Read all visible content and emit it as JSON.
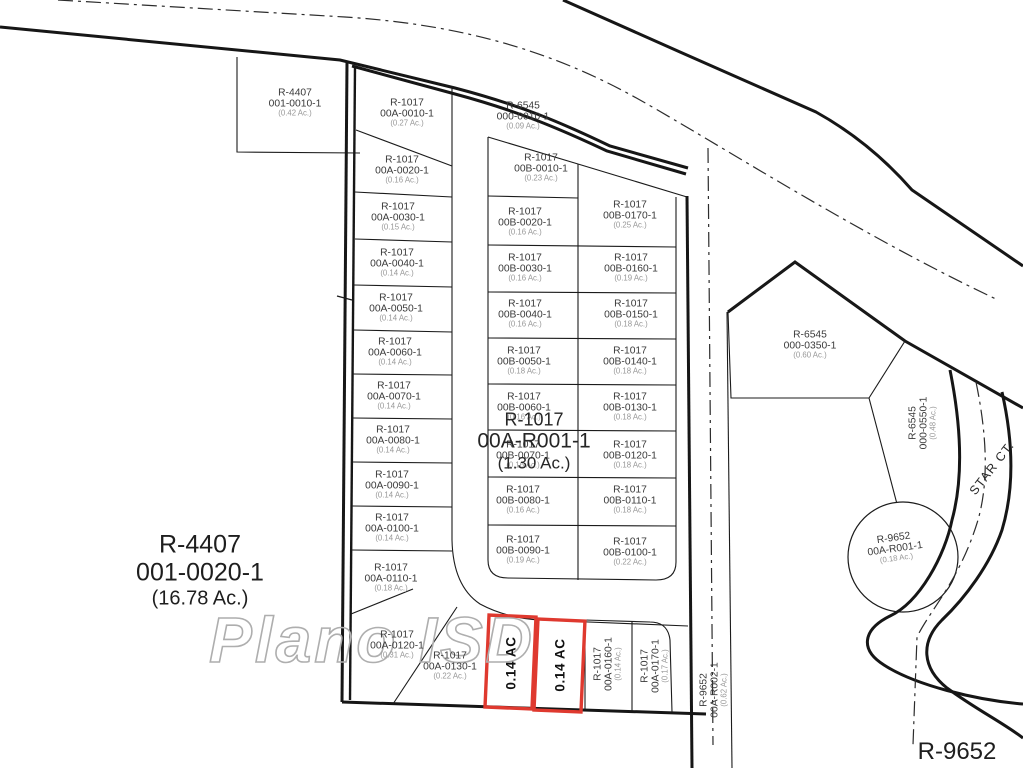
{
  "map": {
    "type": "parcel-plat-map",
    "watermark": {
      "text": "Plano ISD"
    },
    "highlight_color": "#df392f",
    "line_color": "#1b1b1b",
    "highlighted_lots": [
      {
        "label": "0.14 AC"
      },
      {
        "label": "0.14 AC"
      }
    ]
  },
  "labels": [
    {
      "name": "parcel-label-001-0010-1",
      "cls": "sm",
      "x": 295,
      "y": 103,
      "rot": 0,
      "lines": [
        "R-4407",
        "001-0010-1",
        "(0.42 Ac.)"
      ]
    },
    {
      "name": "parcel-label-000-0010-1",
      "cls": "sm",
      "x": 523,
      "y": 116,
      "rot": 0,
      "lines": [
        "R-6545",
        "000-0010-1",
        "(0.09 Ac.)"
      ]
    },
    {
      "name": "parcel-label-00A-0010-1",
      "cls": "sm",
      "x": 407,
      "y": 113,
      "rot": 0,
      "lines": [
        "R-1017",
        "00A-0010-1",
        "(0.27 Ac.)"
      ]
    },
    {
      "name": "parcel-label-00A-0020-1",
      "cls": "sm",
      "x": 402,
      "y": 170,
      "rot": 0,
      "lines": [
        "R-1017",
        "00A-0020-1",
        "(0.16 Ac.)"
      ]
    },
    {
      "name": "parcel-label-00A-0030-1",
      "cls": "sm",
      "x": 398,
      "y": 217,
      "rot": 0,
      "lines": [
        "R-1017",
        "00A-0030-1",
        "(0.15 Ac.)"
      ]
    },
    {
      "name": "parcel-label-00A-0040-1",
      "cls": "sm",
      "x": 397,
      "y": 263,
      "rot": 0,
      "lines": [
        "R-1017",
        "00A-0040-1",
        "(0.14 Ac.)"
      ]
    },
    {
      "name": "parcel-label-00A-0050-1",
      "cls": "sm",
      "x": 396,
      "y": 308,
      "rot": 0,
      "lines": [
        "R-1017",
        "00A-0050-1",
        "(0.14 Ac.)"
      ]
    },
    {
      "name": "parcel-label-00A-0060-1",
      "cls": "sm",
      "x": 395,
      "y": 352,
      "rot": 0,
      "lines": [
        "R-1017",
        "00A-0060-1",
        "(0.14 Ac.)"
      ]
    },
    {
      "name": "parcel-label-00A-0070-1",
      "cls": "sm",
      "x": 394,
      "y": 396,
      "rot": 0,
      "lines": [
        "R-1017",
        "00A-0070-1",
        "(0.14 Ac.)"
      ]
    },
    {
      "name": "parcel-label-00A-0080-1",
      "cls": "sm",
      "x": 393,
      "y": 440,
      "rot": 0,
      "lines": [
        "R-1017",
        "00A-0080-1",
        "(0.14 Ac.)"
      ]
    },
    {
      "name": "parcel-label-00A-0090-1",
      "cls": "sm",
      "x": 392,
      "y": 485,
      "rot": 0,
      "lines": [
        "R-1017",
        "00A-0090-1",
        "(0.14 Ac.)"
      ]
    },
    {
      "name": "parcel-label-00A-0100-1",
      "cls": "sm",
      "x": 392,
      "y": 528,
      "rot": 0,
      "lines": [
        "R-1017",
        "00A-0100-1",
        "(0.14 Ac.)"
      ]
    },
    {
      "name": "parcel-label-00A-0110-1",
      "cls": "sm",
      "x": 391,
      "y": 578,
      "rot": 0,
      "lines": [
        "R-1017",
        "00A-0110-1",
        "(0.18 Ac.)"
      ]
    },
    {
      "name": "parcel-label-00A-0120-1",
      "cls": "sm",
      "x": 397,
      "y": 645,
      "rot": 0,
      "lines": [
        "R-1017",
        "00A-0120-1",
        "(0.31 Ac.)"
      ]
    },
    {
      "name": "parcel-label-00A-0130-1",
      "cls": "sm",
      "x": 450,
      "y": 666,
      "rot": 0,
      "lines": [
        "R-1017",
        "00A-0130-1",
        "(0.22 Ac.)"
      ]
    },
    {
      "name": "parcel-label-00B-0010-1",
      "cls": "sm",
      "x": 541,
      "y": 168,
      "rot": 0,
      "lines": [
        "R-1017",
        "00B-0010-1",
        "(0.23 Ac.)"
      ]
    },
    {
      "name": "parcel-label-00B-0020-1",
      "cls": "sm",
      "x": 525,
      "y": 222,
      "rot": 0,
      "lines": [
        "R-1017",
        "00B-0020-1",
        "(0.16 Ac.)"
      ]
    },
    {
      "name": "parcel-label-00B-0030-1",
      "cls": "sm",
      "x": 525,
      "y": 268,
      "rot": 0,
      "lines": [
        "R-1017",
        "00B-0030-1",
        "(0.16 Ac.)"
      ]
    },
    {
      "name": "parcel-label-00B-0040-1",
      "cls": "sm",
      "x": 525,
      "y": 314,
      "rot": 0,
      "lines": [
        "R-1017",
        "00B-0040-1",
        "(0.16 Ac.)"
      ]
    },
    {
      "name": "parcel-label-00B-0050-1",
      "cls": "sm",
      "x": 524,
      "y": 361,
      "rot": 0,
      "lines": [
        "R-1017",
        "00B-0050-1",
        "(0.18 Ac.)"
      ]
    },
    {
      "name": "parcel-label-00B-0060-1",
      "cls": "sm",
      "x": 524,
      "y": 407,
      "rot": 0,
      "lines": [
        "R-1017",
        "00B-0060-1",
        "(0.16 Ac.)"
      ]
    },
    {
      "name": "parcel-label-00B-0070-1",
      "cls": "sm",
      "x": 523,
      "y": 455,
      "rot": 0,
      "lines": [
        "R-1017",
        "00B-0070-1",
        "(0.16 Ac.)"
      ]
    },
    {
      "name": "parcel-label-00B-0080-1",
      "cls": "sm",
      "x": 523,
      "y": 500,
      "rot": 0,
      "lines": [
        "R-1017",
        "00B-0080-1",
        "(0.16 Ac.)"
      ]
    },
    {
      "name": "parcel-label-00B-0090-1",
      "cls": "sm",
      "x": 523,
      "y": 550,
      "rot": 0,
      "lines": [
        "R-1017",
        "00B-0090-1",
        "(0.19 Ac.)"
      ]
    },
    {
      "name": "parcel-label-00B-0170-1",
      "cls": "sm",
      "x": 630,
      "y": 215,
      "rot": 0,
      "lines": [
        "R-1017",
        "00B-0170-1",
        "(0.25 Ac.)"
      ]
    },
    {
      "name": "parcel-label-00B-0160-1",
      "cls": "sm",
      "x": 631,
      "y": 268,
      "rot": 0,
      "lines": [
        "R-1017",
        "00B-0160-1",
        "(0.19 Ac.)"
      ]
    },
    {
      "name": "parcel-label-00B-0150-1",
      "cls": "sm",
      "x": 631,
      "y": 314,
      "rot": 0,
      "lines": [
        "R-1017",
        "00B-0150-1",
        "(0.18 Ac.)"
      ]
    },
    {
      "name": "parcel-label-00B-0140-1",
      "cls": "sm",
      "x": 630,
      "y": 361,
      "rot": 0,
      "lines": [
        "R-1017",
        "00B-0140-1",
        "(0.18 Ac.)"
      ]
    },
    {
      "name": "parcel-label-00B-0130-1",
      "cls": "sm",
      "x": 630,
      "y": 407,
      "rot": 0,
      "lines": [
        "R-1017",
        "00B-0130-1",
        "(0.18 Ac.)"
      ]
    },
    {
      "name": "parcel-label-00B-0120-1",
      "cls": "sm",
      "x": 630,
      "y": 455,
      "rot": 0,
      "lines": [
        "R-1017",
        "00B-0120-1",
        "(0.18 Ac.)"
      ]
    },
    {
      "name": "parcel-label-00B-0110-1",
      "cls": "sm",
      "x": 630,
      "y": 500,
      "rot": 0,
      "lines": [
        "R-1017",
        "00B-0110-1",
        "(0.18 Ac.)"
      ]
    },
    {
      "name": "parcel-label-00B-0100-1",
      "cls": "sm",
      "x": 630,
      "y": 552,
      "rot": 0,
      "lines": [
        "R-1017",
        "00B-0100-1",
        "(0.22 Ac.)"
      ]
    },
    {
      "name": "parcel-label-000-0350-1",
      "cls": "sm",
      "x": 810,
      "y": 345,
      "rot": 0,
      "lines": [
        "R-6545",
        "000-0350-1",
        "(0.60 Ac.)"
      ]
    },
    {
      "name": "parcel-label-000-0550-1",
      "cls": "sm",
      "x": 923,
      "y": 423,
      "rot": -90,
      "lines": [
        "R-6545",
        "000-0550-1",
        "(0.48 Ac.)"
      ]
    },
    {
      "name": "parcel-label-00A-R001-1-circle",
      "cls": "sm",
      "x": 895,
      "y": 548,
      "rot": -8,
      "lines": [
        "R-9652",
        "00A-R001-1",
        "(0.18 Ac.)"
      ]
    },
    {
      "name": "parcel-label-00A-R002-1",
      "cls": "sm",
      "x": 714,
      "y": 690,
      "rot": -90,
      "lines": [
        "R-9652",
        "00A-R002-1",
        "(0.62 Ac.)"
      ]
    },
    {
      "name": "parcel-label-00A-0160-1",
      "cls": "sm",
      "x": 608,
      "y": 664,
      "rot": -90,
      "lines": [
        "R-1017",
        "00A-0160-1",
        "(0.14 Ac.)"
      ]
    },
    {
      "name": "parcel-label-00A-0170-1",
      "cls": "sm",
      "x": 655,
      "y": 666,
      "rot": -90,
      "lines": [
        "R-1017",
        "00A-0170-1",
        "(0.17 Ac.)"
      ]
    },
    {
      "name": "highlight-label-1",
      "cls": "redlbl",
      "x": 511,
      "y": 663,
      "rot": -90,
      "lines": [
        "0.14 AC"
      ]
    },
    {
      "name": "highlight-label-2",
      "cls": "redlbl",
      "x": 560,
      "y": 665,
      "rot": -90,
      "lines": [
        "0.14 AC"
      ]
    },
    {
      "name": "parcel-label-001-0020-1",
      "cls": "big1",
      "x": 200,
      "y": 570,
      "rot": 0,
      "lines": [
        "R-4407",
        "001-0020-1",
        "(16.78 Ac.)"
      ]
    },
    {
      "name": "parcel-label-00A-R001-1-main",
      "cls": "big2",
      "x": 534,
      "y": 441,
      "rot": 0,
      "lines": [
        "R-1017",
        "00A-R001-1",
        "(1.30 Ac.)"
      ]
    },
    {
      "name": "parcel-label-R-9652-corner",
      "cls": "big3",
      "x": 957,
      "y": 752,
      "rot": 0,
      "lines": [
        "R-9652"
      ]
    },
    {
      "name": "street-label-star-ct",
      "cls": "street",
      "x": 992,
      "y": 468,
      "rot": -52,
      "lines": [
        "STAR CT."
      ]
    }
  ]
}
